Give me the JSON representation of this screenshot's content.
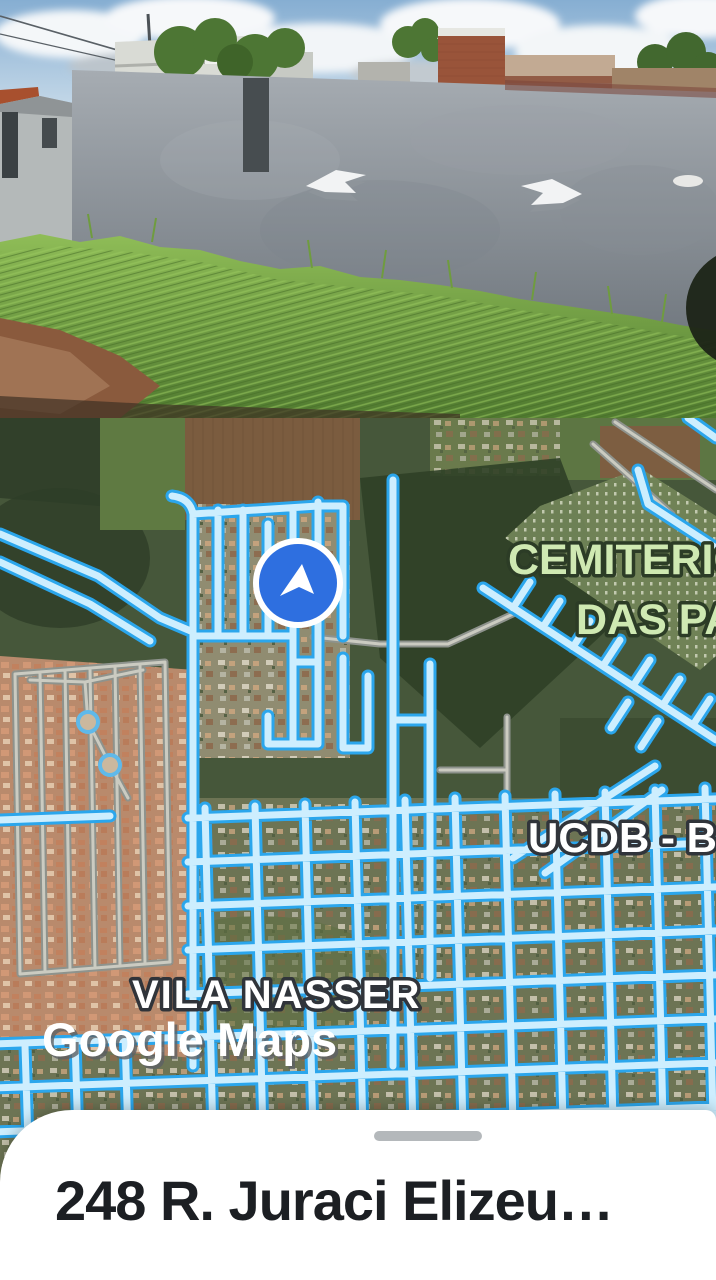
{
  "street_view": {
    "icons": {
      "arrow_left": "street-nav-arrow-left",
      "arrow_right": "street-nav-arrow-right"
    }
  },
  "map": {
    "labels": {
      "cemiterio_line1": "CEMITERIO",
      "cemiterio_line2": "DAS PA",
      "ucdb": "UCDB - Bl",
      "vila_nasser": "VILA NASSER"
    },
    "watermark": "Google Maps",
    "marker_icon": "current-location-heading",
    "colors": {
      "road_fill": "#cdeefe",
      "road_casing": "#2ba6ec",
      "marker_blue": "#2e6fe0",
      "label_green": "#cfe9b2"
    }
  },
  "bottom_sheet": {
    "address": "248 R. Juraci Elizeu…"
  }
}
